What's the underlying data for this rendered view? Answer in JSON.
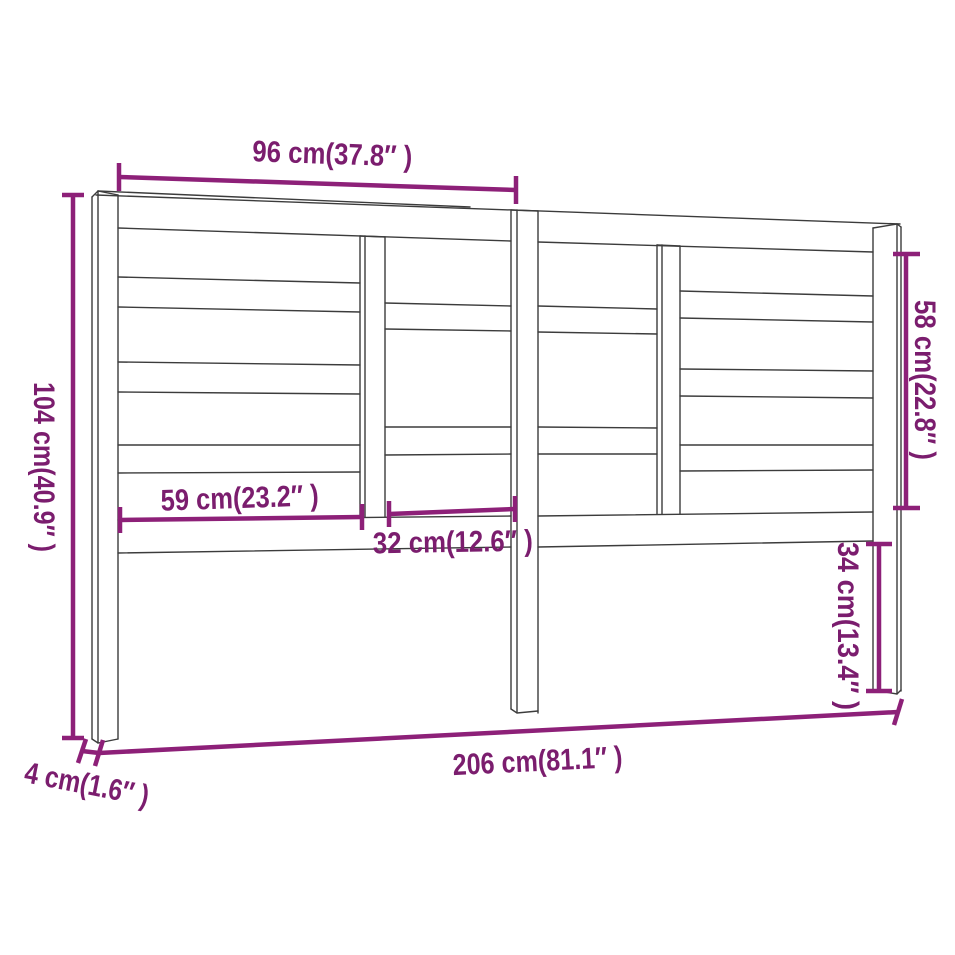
{
  "figure": {
    "type": "furniture-dimension-diagram",
    "subject": "bed headboard with staggered horizontal slats, three legs and two divider posts",
    "background_color": "#ffffff",
    "outline_color": "#3c3c3c",
    "dimension_line_color": "#8d2078",
    "dimension_text_color": "#7b1d6e"
  },
  "dimensions": {
    "top_width": "96 cm(37.8″ )",
    "overall_height": "104 cm(40.9″ )",
    "upper_right_height": "58 cm(22.8″ )",
    "left_section_width": "59 cm(23.2″ )",
    "middle_section_width": "32 cm(12.6″ )",
    "leg_below_rail_height": "34 cm(13.4″ )",
    "overall_width": "206 cm(81.1″ )",
    "leg_thickness": "4 cm(1.6″ )"
  }
}
